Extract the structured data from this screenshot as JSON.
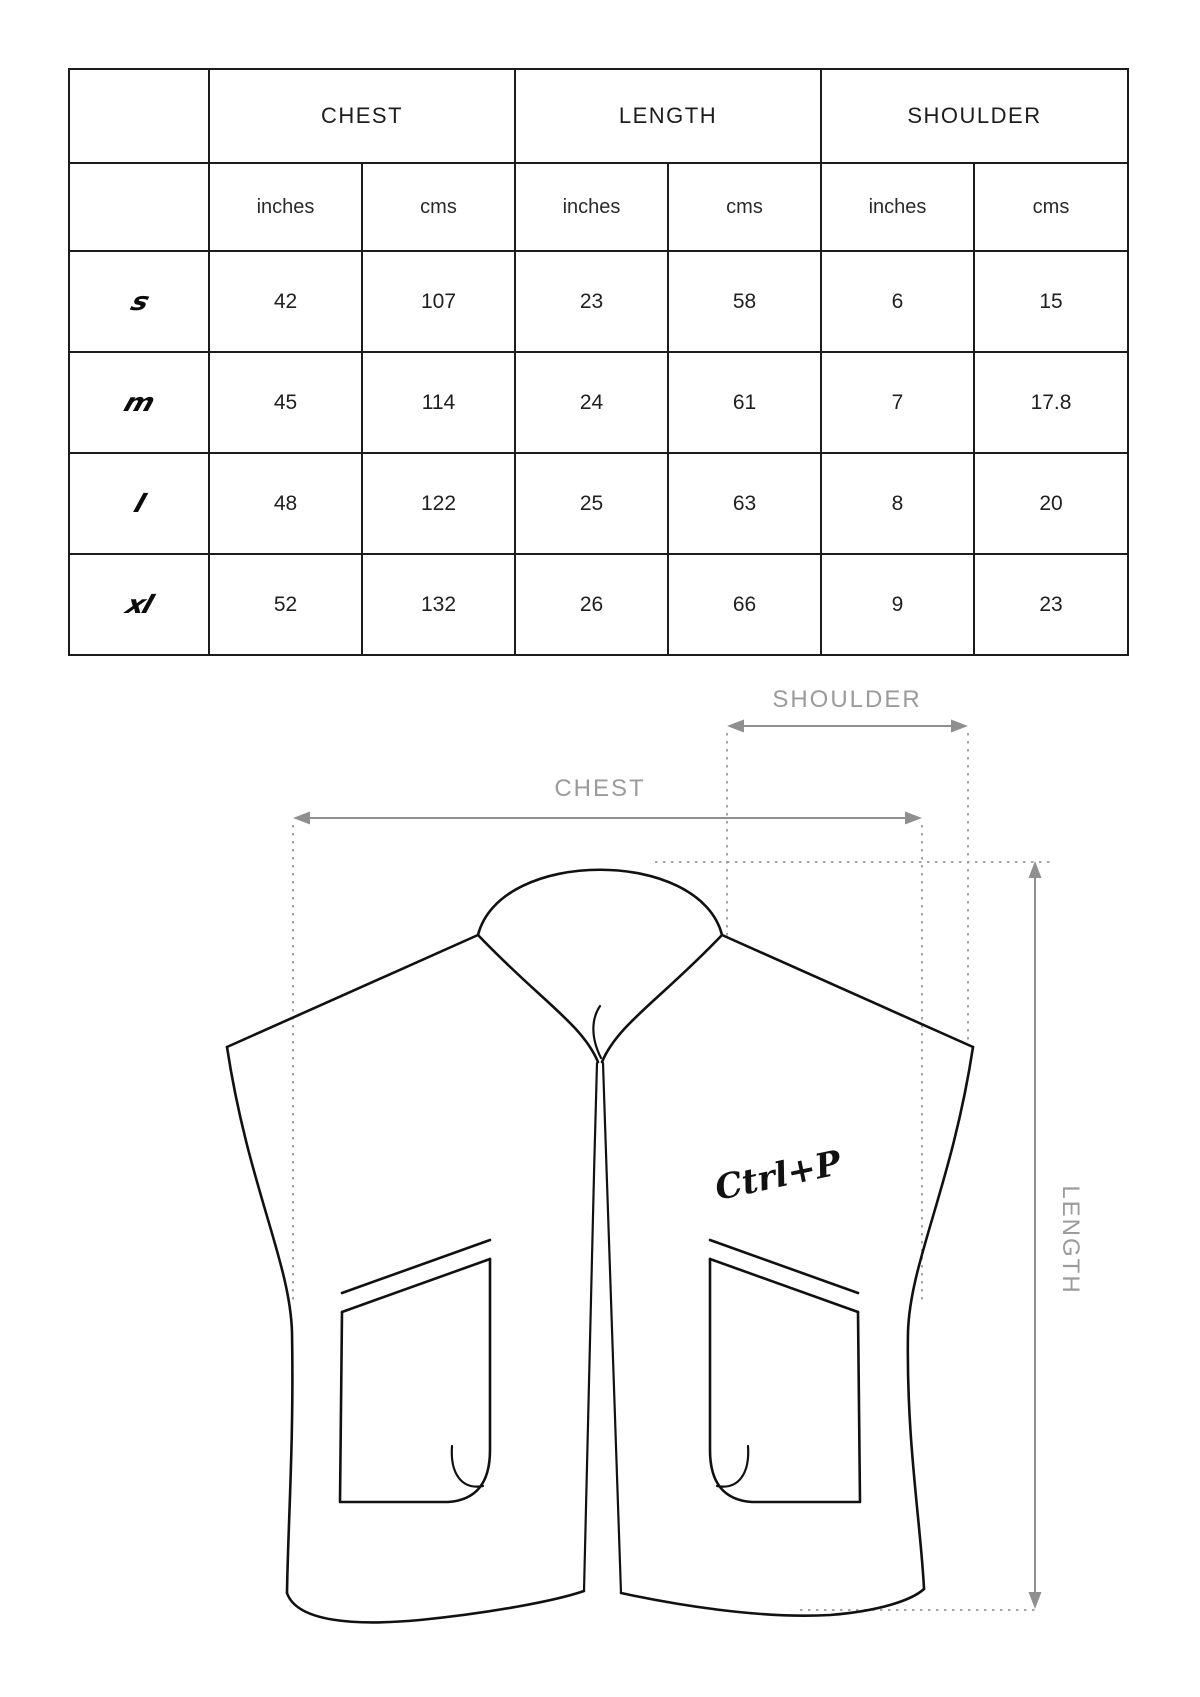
{
  "size_table": {
    "corner_label": "",
    "groups": [
      {
        "label": "CHEST"
      },
      {
        "label": "LENGTH"
      },
      {
        "label": "SHOULDER"
      }
    ],
    "unit_row": [
      "inches",
      "cms",
      "inches",
      "cms",
      "inches",
      "cms"
    ],
    "rows": [
      {
        "size": "s",
        "values": {
          "chest_in": "42",
          "chest_cm": "107",
          "len_in": "23",
          "len_cm": "58",
          "sh_in": "6",
          "sh_cm": "15"
        }
      },
      {
        "size": "m",
        "values": {
          "chest_in": "45",
          "chest_cm": "114",
          "len_in": "24",
          "len_cm": "61",
          "sh_in": "7",
          "sh_cm": "17.8"
        }
      },
      {
        "size": "l",
        "values": {
          "chest_in": "48",
          "chest_cm": "122",
          "len_in": "25",
          "len_cm": "63",
          "sh_in": "8",
          "sh_cm": "20"
        }
      },
      {
        "size": "xl",
        "values": {
          "chest_in": "52",
          "chest_cm": "132",
          "len_in": "26",
          "len_cm": "66",
          "sh_in": "9",
          "sh_cm": "23"
        }
      }
    ]
  },
  "diagram": {
    "shoulder_label": "SHOULDER",
    "chest_label": "CHEST",
    "length_label": "LENGTH",
    "logo_text": "Ctrl+P",
    "colors": {
      "dimension_line": "#8f8f8f",
      "dimension_label": "#9b9b9b",
      "garment_outline": "#111111",
      "dotted_guide": "#9a9a9a"
    }
  }
}
